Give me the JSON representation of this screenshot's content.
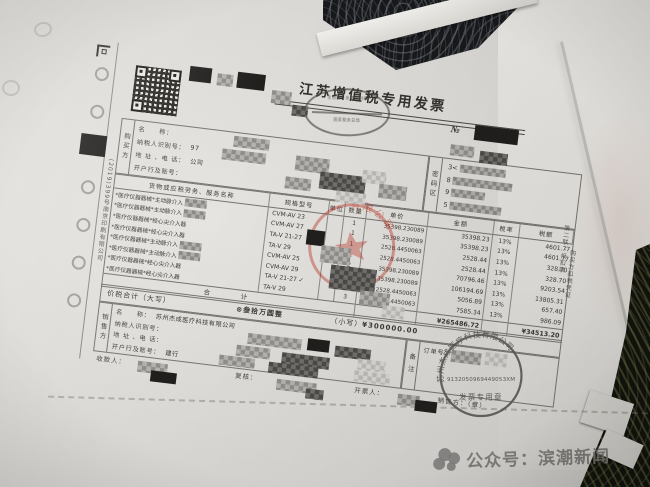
{
  "photo": {
    "watermark": {
      "text": "公众号：滨潮新闻",
      "logo": "paw-circles-logo"
    }
  },
  "invoice": {
    "title": "江苏增值税专用发票",
    "serial_label": "№",
    "monitor_stamp": {
      "line1": "全国统一发票监制章",
      "line2": "国家税务总局"
    },
    "buyer": {
      "section_label": "购买方",
      "rows": [
        {
          "label": "名　　称："
        },
        {
          "label": "纳税人识别号：",
          "extra": "97"
        },
        {
          "label": "地 址 、电 话：",
          "extra": "公司"
        },
        {
          "label": "开户行及账号："
        }
      ]
    },
    "password_area": {
      "label": "密码区",
      "lines": [
        "3<",
        "8",
        "9",
        "5"
      ]
    },
    "table": {
      "headers": [
        "货物或应税劳务、服务名称",
        "规格型号",
        "单位",
        "数量",
        "单价",
        "金额",
        "税率",
        "税额"
      ],
      "rows": [
        {
          "name": "*医疗仪器器械*主动脉介入",
          "censored_tail": true,
          "spec": "CVM-AV 23",
          "qty": "1",
          "price": "35398.230089",
          "amount": "35398.23",
          "rate": "13%",
          "tax": "4601.77"
        },
        {
          "name": "*医疗仪器器械*主动脉介入",
          "censored_tail": true,
          "spec": "CVM-AV 27",
          "qty": "1",
          "price": "35398.230089",
          "amount": "35398.23",
          "rate": "13%",
          "tax": "4601.77"
        },
        {
          "name": "*医疗仪器器械*经心尖介入器",
          "spec": "TA-V 21-27",
          "qty": "1",
          "price": "2528.4450063",
          "amount": "2528.44",
          "rate": "13%",
          "tax": "328.70"
        },
        {
          "name": "*医疗仪器器械*经心尖介入器",
          "spec": "TA-V 29",
          "qty": "1",
          "price": "2528.4450063",
          "amount": "2528.44",
          "rate": "13%",
          "tax": "328.70"
        },
        {
          "name": "*医疗仪器器械*主动脉介入",
          "censored_tail": true,
          "spec": "CVM-AV 25",
          "qty": "2",
          "price": "35398.230089",
          "amount": "70796.46",
          "rate": "13%",
          "tax": "9203.54"
        },
        {
          "name": "*医疗仪器器械*主动脉介入",
          "censored_tail": true,
          "spec": "CVM-AV 29",
          "qty": "3",
          "price": "35398.230089",
          "amount": "106194.69",
          "rate": "13%",
          "tax": "13805.31"
        },
        {
          "name": "*医疗仪器器械*经心尖介入器",
          "spec": "TA-V 21-27",
          "check": true,
          "qty": "2",
          "price": "2528.4450063",
          "amount": "5056.89",
          "rate": "13%",
          "tax": "657.40"
        },
        {
          "name": "*医疗仪器器械*经心尖介入器",
          "spec": "TA-V 29",
          "qty": "3",
          "price": "2528.4450063",
          "amount": "7585.34",
          "rate": "13%",
          "tax": "986.09"
        }
      ],
      "total": {
        "label": "合　　计",
        "amount": "¥265486.72",
        "tax": "¥34513.20"
      }
    },
    "totals_row": {
      "label": "价税合计（大写）",
      "words": "⊗叁拾万圆整",
      "small_label": "（小写）",
      "small_value": "¥300000.00"
    },
    "seller": {
      "section_label": "销售方",
      "rows": [
        {
          "label": "名　　称：",
          "extra": "苏州杰成医疗科技有限公司"
        },
        {
          "label": "纳税人识别号："
        },
        {
          "label": "地 址 、电 话："
        },
        {
          "label": "开户行及账号：",
          "extra": "建行"
        }
      ]
    },
    "remark": {
      "label": "备注",
      "order_label": "订单号："
    },
    "footer": {
      "payee": "收款人：",
      "reviewer": "复核：",
      "drawer": "开票人：",
      "seller_seal": "销售方：（章）"
    },
    "stamps": {
      "red_company_stamp_visible": "有限公司",
      "seal": {
        "company": "苏州杰成医疗科技有限公司",
        "code": "9132050969449053XM",
        "caption": "发票专用章"
      }
    },
    "edge_text": {
      "left_print": "(2019)399号南京印刷有限公司",
      "copy_name": "第二联：抵扣联",
      "copy_use": "购买方扣税凭证"
    }
  }
}
